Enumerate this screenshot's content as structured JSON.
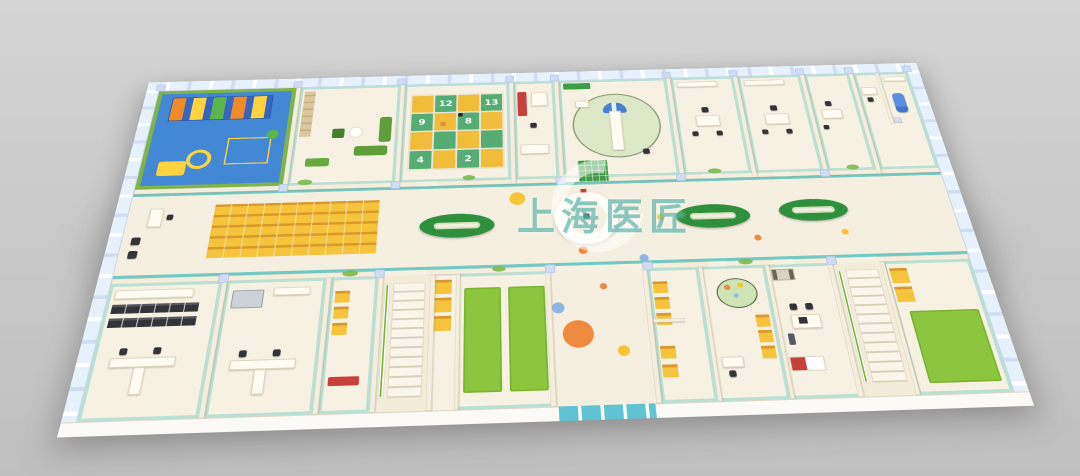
{
  "watermark": {
    "text": "上海医匠",
    "logo_letter": "C"
  },
  "rooms": {
    "game": {
      "tiles": [
        "12",
        "13",
        "9",
        "8",
        "4",
        "2"
      ]
    }
  },
  "palette": {
    "bgTop": "#d4d4d4",
    "bgBottom": "#bfbfbf",
    "wall": "#f4eedf",
    "wallEdge": "#ddd3bd",
    "floor": "#f6f1e2",
    "corridorFloor": "#f4efe0",
    "teal": "#72c9c3",
    "glass": "#e7f1fb",
    "pillar": "#cfdcf2",
    "playBlue": "#4388d4",
    "playDeck": "#3566c4",
    "lime": "#8cc63e",
    "limeDark": "#79b32f",
    "green": "#3f9d45",
    "sofaGreen": "#5f9e3b",
    "ovalGreen": "#2e8f3c",
    "gridYellow": "#f2bc3b",
    "gridGreen": "#56ad74",
    "chair": "#f5c33c",
    "chairEdge": "#d9992b",
    "dotOrange": "#ee8a3d",
    "dotYellow": "#f4c534",
    "dotBlue": "#90b6e8",
    "red": "#c8403a",
    "medBlue": "#4a7fd6",
    "dark": "#33343a",
    "doorTeal": "#5fc3d4",
    "wood": "#d9c79d",
    "rug": "#dde8c8",
    "rugEdge": "#8a9b6f",
    "wmTeal": "rgba(27,150,139,0.5)",
    "shadow": "rgba(96,96,96,0.5)"
  }
}
